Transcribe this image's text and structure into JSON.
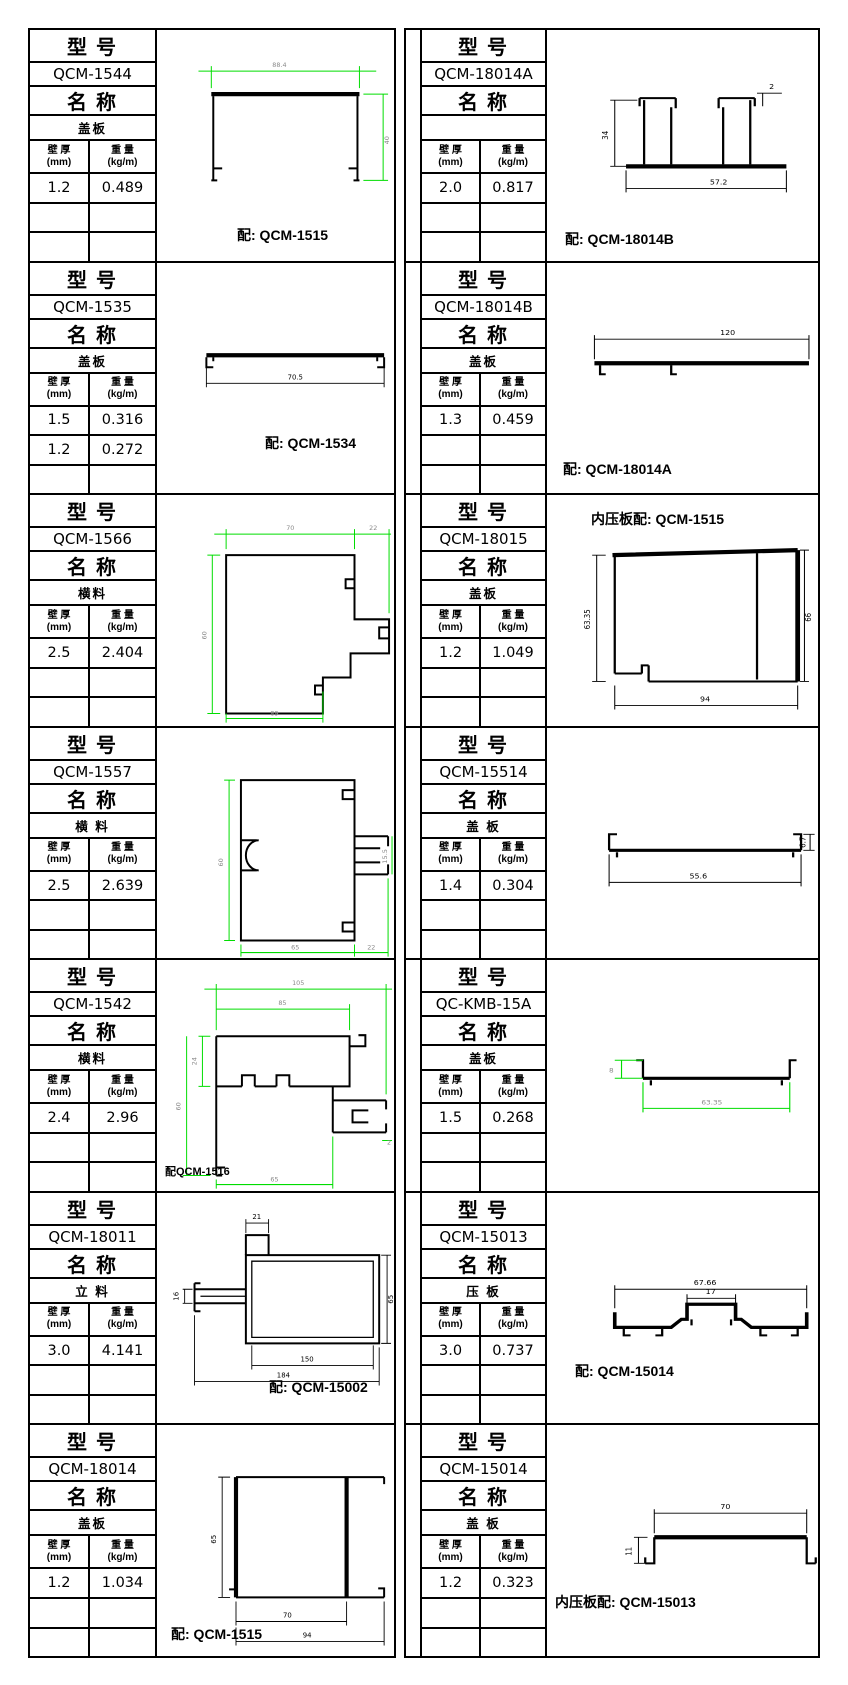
{
  "labels": {
    "model_header": "型 号",
    "name_header": "名 称",
    "thickness_header": "壁 厚",
    "thickness_unit": "(mm)",
    "weight_header": "重 量",
    "weight_unit": "(kg/m)"
  },
  "colors": {
    "dimension_line_green": "#00dd00",
    "line_black": "#000000"
  },
  "cells": [
    {
      "model": "QCM-1544",
      "name": "盖板",
      "rows": [
        [
          "1.2",
          "0.489"
        ],
        [
          "",
          ""
        ],
        [
          "",
          ""
        ]
      ],
      "caption": "配: QCM-1515",
      "dims": {
        "w": "88.4",
        "h": "40"
      }
    },
    {
      "model": "QCM-18014A",
      "name": "",
      "rows": [
        [
          "2.0",
          "0.817"
        ],
        [
          "",
          ""
        ],
        [
          "",
          ""
        ]
      ],
      "caption": "配: QCM-18014B",
      "dims": {
        "h": "34",
        "t": "2",
        "w": "57.2"
      }
    },
    {
      "model": "QCM-1535",
      "name": "盖板",
      "rows": [
        [
          "1.5",
          "0.316"
        ],
        [
          "1.2",
          "0.272"
        ],
        [
          "",
          ""
        ]
      ],
      "caption": "配: QCM-1534",
      "dims": {
        "w": "70.5"
      }
    },
    {
      "model": "QCM-18014B",
      "name": "盖板",
      "rows": [
        [
          "1.3",
          "0.459"
        ],
        [
          "",
          ""
        ],
        [
          "",
          ""
        ]
      ],
      "caption": "配: QCM-18014A",
      "dims": {
        "w": "120"
      }
    },
    {
      "model": "QCM-1566",
      "name": "横料",
      "rows": [
        [
          "2.5",
          "2.404"
        ],
        [
          "",
          ""
        ],
        [
          "",
          ""
        ]
      ],
      "caption": "",
      "dims": {
        "w1": "70",
        "w2": "22",
        "h": "60",
        "b": "89"
      }
    },
    {
      "model": "QCM-18015",
      "name": "盖板",
      "rows": [
        [
          "1.2",
          "1.049"
        ],
        [
          "",
          ""
        ],
        [
          "",
          ""
        ]
      ],
      "caption": "内压板配: QCM-1515",
      "dims": {
        "hl": "63.35",
        "hr": "66",
        "b": "94"
      }
    },
    {
      "model": "QCM-1557",
      "name": "横 料",
      "rows": [
        [
          "2.5",
          "2.639"
        ],
        [
          "",
          ""
        ],
        [
          "",
          ""
        ]
      ],
      "caption": "",
      "dims": {
        "h": "60",
        "arm": "15.5",
        "b1": "65",
        "b2": "22"
      }
    },
    {
      "model": "QCM-15514",
      "name": "盖 板",
      "rows": [
        [
          "1.4",
          "0.304"
        ],
        [
          "",
          ""
        ],
        [
          "",
          ""
        ]
      ],
      "caption": "",
      "dims": {
        "w": "55.6",
        "h": "6.7"
      }
    },
    {
      "model": "QCM-1542",
      "name": "横料",
      "rows": [
        [
          "2.4",
          "2.96"
        ],
        [
          "",
          ""
        ],
        [
          "",
          ""
        ]
      ],
      "caption": "配QCM-1516",
      "dims": {
        "w1": "105",
        "w2": "85",
        "h1": "24",
        "h2": "60",
        "r": "2",
        "b": "65"
      }
    },
    {
      "model": "QC-KMB-15A",
      "name": "盖板",
      "rows": [
        [
          "1.5",
          "0.268"
        ],
        [
          "",
          ""
        ],
        [
          "",
          ""
        ]
      ],
      "caption": "",
      "dims": {
        "h": "8",
        "w": "63.35"
      }
    },
    {
      "model": "QCM-18011",
      "name": "立 料",
      "rows": [
        [
          "3.0",
          "4.141"
        ],
        [
          "",
          ""
        ],
        [
          "",
          ""
        ]
      ],
      "caption": "配: QCM-15002",
      "dims": {
        "t": "21",
        "l": "16",
        "h": "65",
        "wi": "150",
        "wo": "184"
      }
    },
    {
      "model": "QCM-15013",
      "name": "压 板",
      "rows": [
        [
          "3.0",
          "0.737"
        ],
        [
          "",
          ""
        ],
        [
          "",
          ""
        ]
      ],
      "caption": "配: QCM-15014",
      "dims": {
        "w": "67.66",
        "c": "17"
      }
    },
    {
      "model": "QCM-18014",
      "name": "盖板",
      "rows": [
        [
          "1.2",
          "1.034"
        ],
        [
          "",
          ""
        ],
        [
          "",
          ""
        ]
      ],
      "caption": "配: QCM-1515",
      "dims": {
        "h": "65",
        "wi": "70",
        "wo": "94"
      }
    },
    {
      "model": "QCM-15014",
      "name": "盖 板",
      "rows": [
        [
          "1.2",
          "0.323"
        ],
        [
          "",
          ""
        ],
        [
          "",
          ""
        ]
      ],
      "caption": "内压板配: QCM-15013",
      "dims": {
        "w": "70",
        "h": "11"
      }
    }
  ]
}
